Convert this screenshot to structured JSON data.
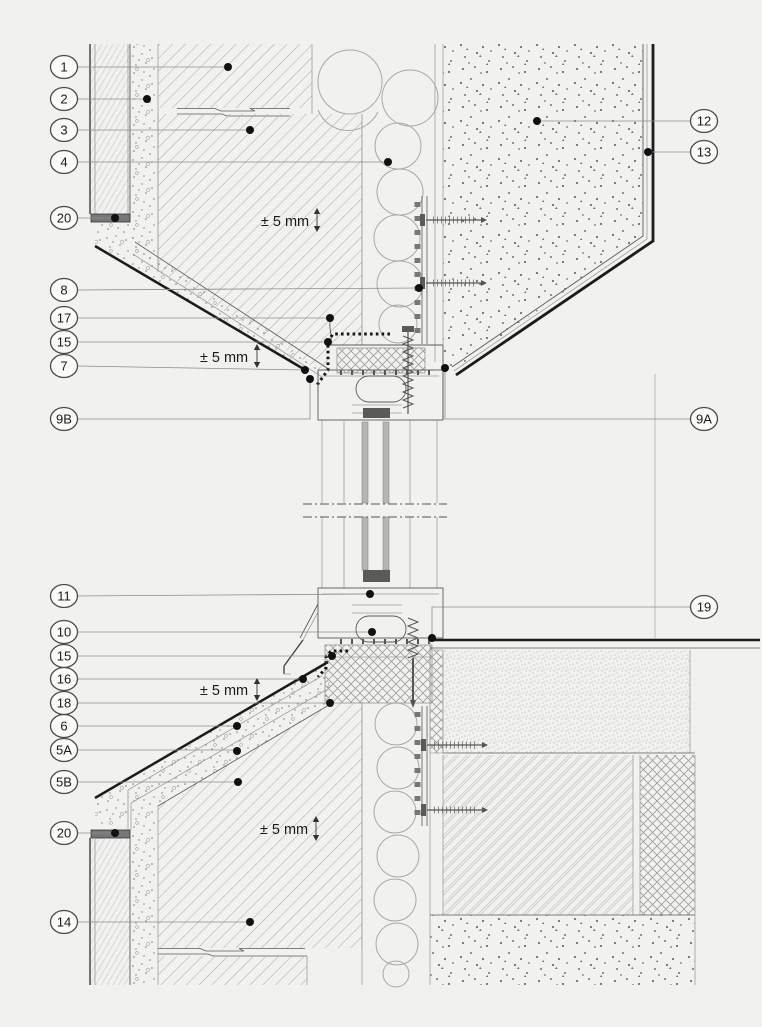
{
  "drawing": {
    "description": "Facade window connection detail - vertical section through window head and sill",
    "tolerance_label": "± 5 mm",
    "callouts": [
      {
        "id": "1"
      },
      {
        "id": "2"
      },
      {
        "id": "3"
      },
      {
        "id": "4"
      },
      {
        "id": "20"
      },
      {
        "id": "8"
      },
      {
        "id": "17"
      },
      {
        "id": "15"
      },
      {
        "id": "7"
      },
      {
        "id": "9B"
      },
      {
        "id": "11"
      },
      {
        "id": "10"
      },
      {
        "id": "15"
      },
      {
        "id": "16"
      },
      {
        "id": "18"
      },
      {
        "id": "6"
      },
      {
        "id": "5A"
      },
      {
        "id": "5B"
      },
      {
        "id": "20"
      },
      {
        "id": "14"
      },
      {
        "id": "12"
      },
      {
        "id": "13"
      },
      {
        "id": "9A"
      },
      {
        "id": "19"
      }
    ]
  }
}
